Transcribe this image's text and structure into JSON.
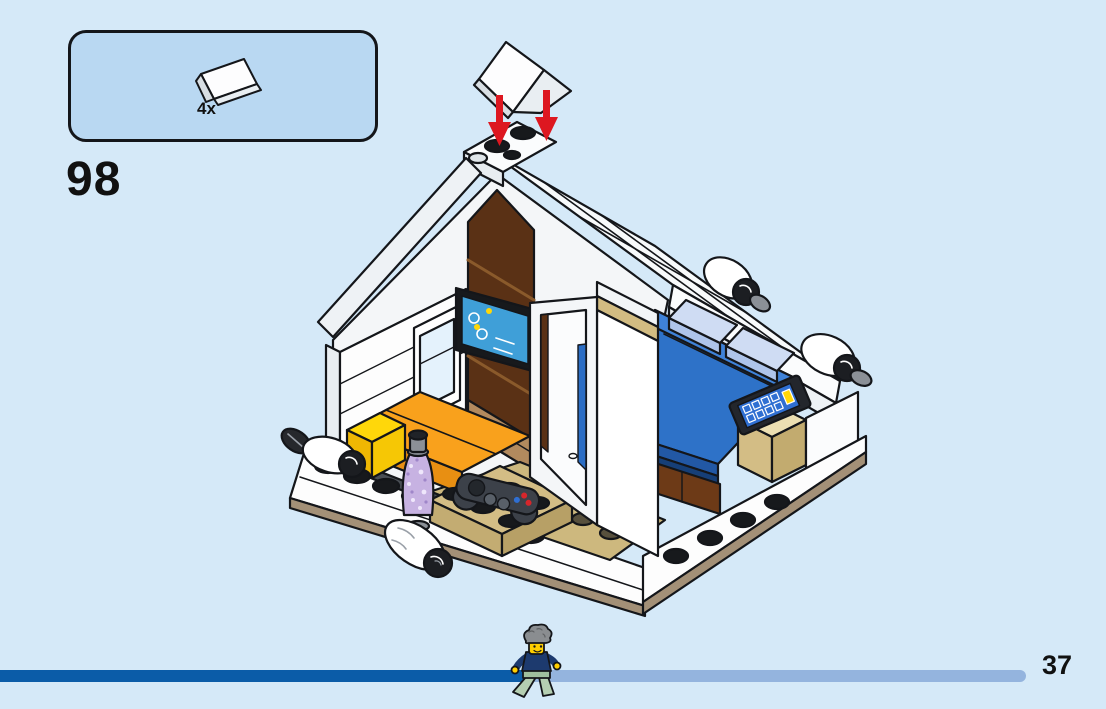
{
  "page": {
    "step_number": "98",
    "page_number": "37"
  },
  "parts_callout": {
    "quantity_label": "4x",
    "piece_name": "white-roof-ridge-slope-piece",
    "piece_color": "#ffffff"
  },
  "progress_bar": {
    "completed_fraction": 0.51
  },
  "illustration": {
    "arrow_count": 2,
    "depicted_elements": [
      "house-with-gable-roof",
      "wood-panel-wall",
      "wall-mounted-tv",
      "window",
      "orange-bed",
      "yellow-pillow",
      "lava-lamp",
      "game-controller",
      "open-door-frame",
      "blue-bed",
      "light-blue-pillows",
      "smartphone",
      "bedside-table",
      "rolled-posters",
      "stud-baseplate",
      "walking-minifigure",
      "floating-roof-piece"
    ]
  },
  "theme": {
    "bg": "#d5e9f8",
    "box-fill": "#b9d8f2",
    "outline": "#14161a",
    "arrow": "#dd1720",
    "bar-dark": "#0b5ca8",
    "bar-light": "#94b4de",
    "text": "#111111"
  }
}
